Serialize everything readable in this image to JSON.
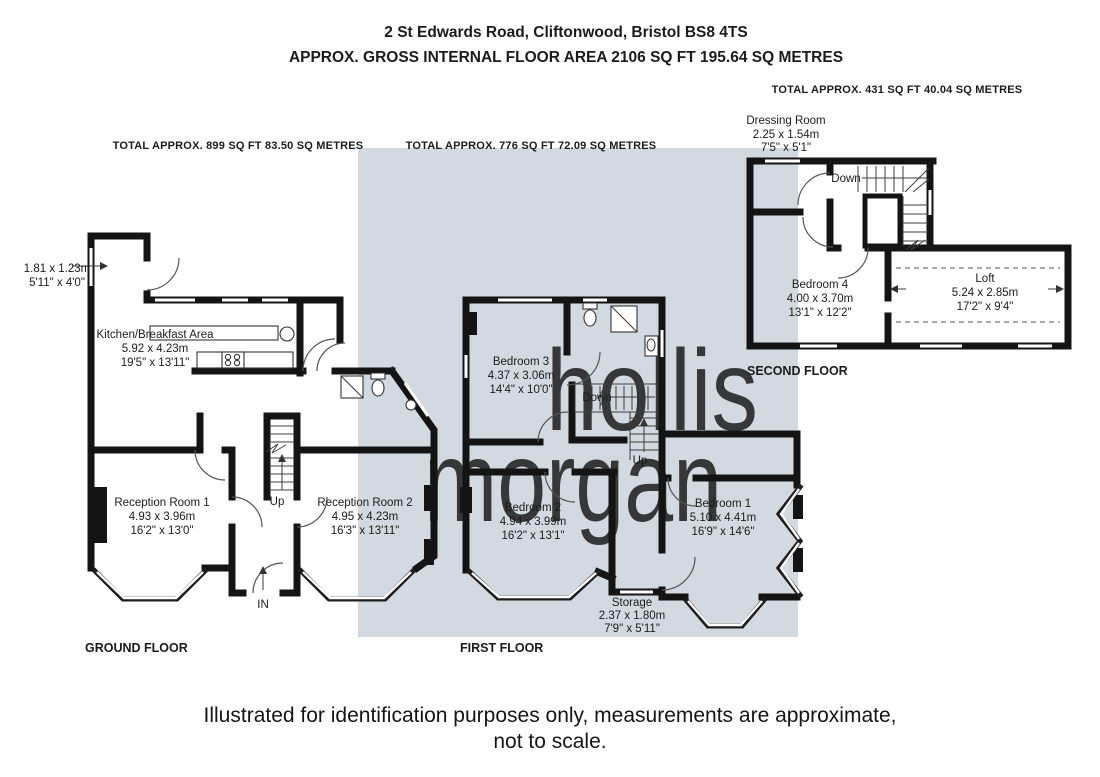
{
  "header": {
    "address": "2 St Edwards Road, Cliftonwood, Bristol BS8 4TS",
    "area": "APPROX. GROSS INTERNAL FLOOR AREA 2106 SQ FT 195.64 SQ METRES"
  },
  "floors": {
    "ground": {
      "label": "GROUND FLOOR",
      "total": "TOTAL APPROX.  899 SQ FT 83.50 SQ METRES",
      "rooms": {
        "porch": {
          "metric": "1.81 x 1.23m",
          "imperial": "5'11\" x 4'0\""
        },
        "kitchen": {
          "name": "Kitchen/Breakfast Area",
          "metric": "5.92 x 4.23m",
          "imperial": "19'5\" x 13'11\""
        },
        "reception1": {
          "name": "Reception Room 1",
          "metric": "4.93 x 3.96m",
          "imperial": "16'2\" x 13'0\""
        },
        "reception2": {
          "name": "Reception Room 2",
          "metric": "4.95 x 4.23m",
          "imperial": "16'3\" x 13'11\""
        }
      },
      "annotations": {
        "up": "Up",
        "entrance": "IN"
      }
    },
    "first": {
      "label": "FIRST FLOOR",
      "total": "TOTAL APPROX.  776 SQ FT  72.09 SQ METRES",
      "rooms": {
        "bedroom3": {
          "name": "Bedroom 3",
          "metric": "4.37 x 3.06m",
          "imperial": "14'4\" x 10'0\""
        },
        "bedroom2": {
          "name": "Bedroom 2",
          "metric": "4.94 x 3.99m",
          "imperial": "16'2\" x 13'1\""
        },
        "bedroom1": {
          "name": "Bedroom 1",
          "metric": "5.10 x 4.41m",
          "imperial": "16'9\" x 14'6\""
        },
        "storage": {
          "name": "Storage",
          "metric": "2.37 x 1.80m",
          "imperial": "7'9\" x 5'11\""
        }
      },
      "annotations": {
        "down": "Down",
        "up": "Up"
      }
    },
    "second": {
      "label": "SECOND FLOOR",
      "total": "TOTAL APPROX.  431 SQ FT  40.04 SQ METRES",
      "rooms": {
        "dressing": {
          "name": "Dressing Room",
          "metric": "2.25 x 1.54m",
          "imperial": "7'5\" x 5'1\""
        },
        "bedroom4": {
          "name": "Bedroom 4",
          "metric": "4.00 x 3.70m",
          "imperial": "13'1\" x 12'2\""
        },
        "loft": {
          "name": "Loft",
          "metric": "5.24 x 2.85m",
          "imperial": "17'2\" x 9'4\""
        }
      },
      "annotations": {
        "down": "Down"
      }
    }
  },
  "watermark": {
    "line1": "hollis",
    "line2": "morgan"
  },
  "footer": {
    "line1": "Illustrated for identification purposes only, measurements are approximate,",
    "line2": "not to scale."
  },
  "colors": {
    "shade": "#d2d9e0",
    "wall": "#141414",
    "watermark_white": "#ffffff",
    "watermark_green": "#e7edb3"
  }
}
